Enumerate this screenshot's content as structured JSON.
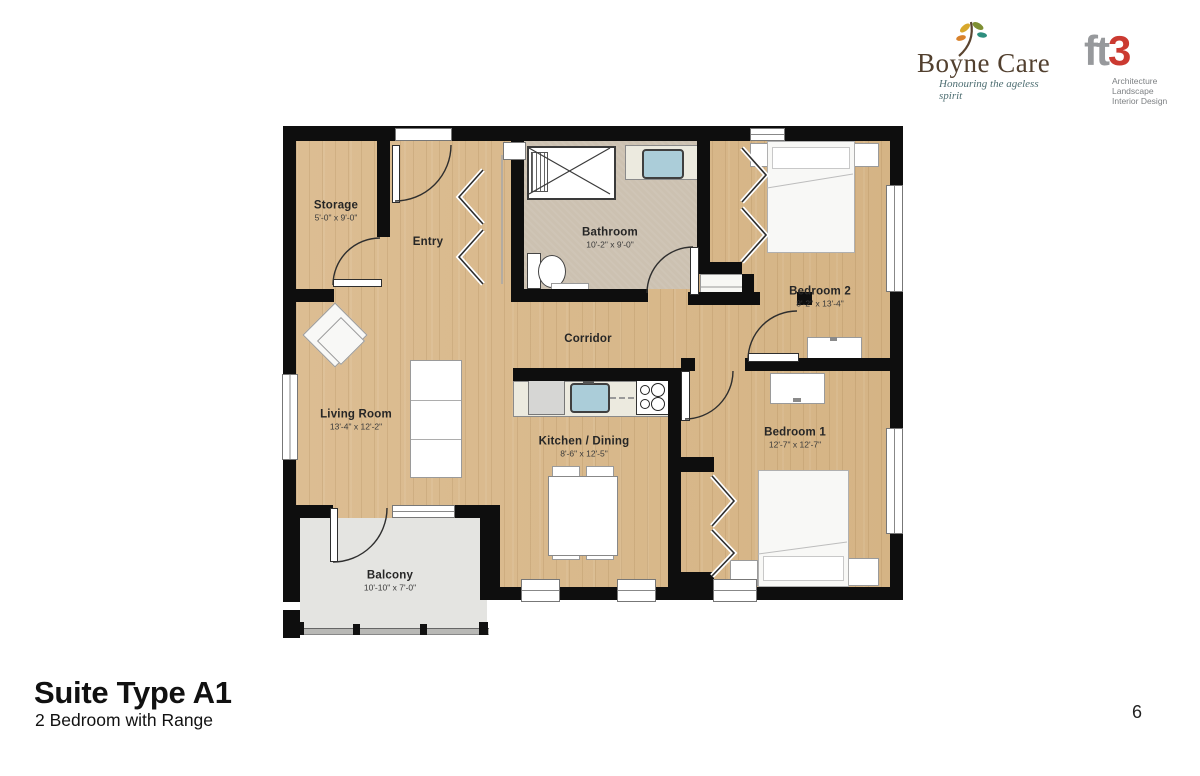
{
  "logos": {
    "boyne": {
      "name": "Boyne Care",
      "tagline": "Honouring the ageless spirit"
    },
    "ft3": {
      "mark_gray": "ft",
      "mark_red": "3",
      "lines": [
        "Architecture",
        "Landscape",
        "Interior Design"
      ]
    }
  },
  "plan": {
    "rooms": [
      {
        "name": "Storage",
        "dims": "5'-0\" x 9'-0\""
      },
      {
        "name": "Entry",
        "dims": ""
      },
      {
        "name": "Bathroom",
        "dims": "10'-2\" x 9'-0\""
      },
      {
        "name": "Bedroom 2",
        "dims": "8'-2\" x 13'-4\""
      },
      {
        "name": "Corridor",
        "dims": ""
      },
      {
        "name": "Living Room",
        "dims": "13'-4\" x 12'-2\""
      },
      {
        "name": "Kitchen / Dining",
        "dims": "8'-6\" x 12'-5\""
      },
      {
        "name": "Bedroom 1",
        "dims": "12'-7\" x 12'-7\""
      },
      {
        "name": "Balcony",
        "dims": "10'-10\" x 7'-0\""
      }
    ]
  },
  "footer": {
    "title": "Suite Type A1",
    "subtitle": "2 Bedroom with Range",
    "page": "6"
  },
  "colors": {
    "wall": "#0e0e0e",
    "wood_floor": "#d8b88c",
    "bath_floor": "#ccc1b1",
    "balcony_floor": "#e4e4e1",
    "logo_brown": "#52402f",
    "ft3_red": "#cb3a31",
    "ft3_gray": "#97999c",
    "sink_blue": "#abcdd9"
  }
}
